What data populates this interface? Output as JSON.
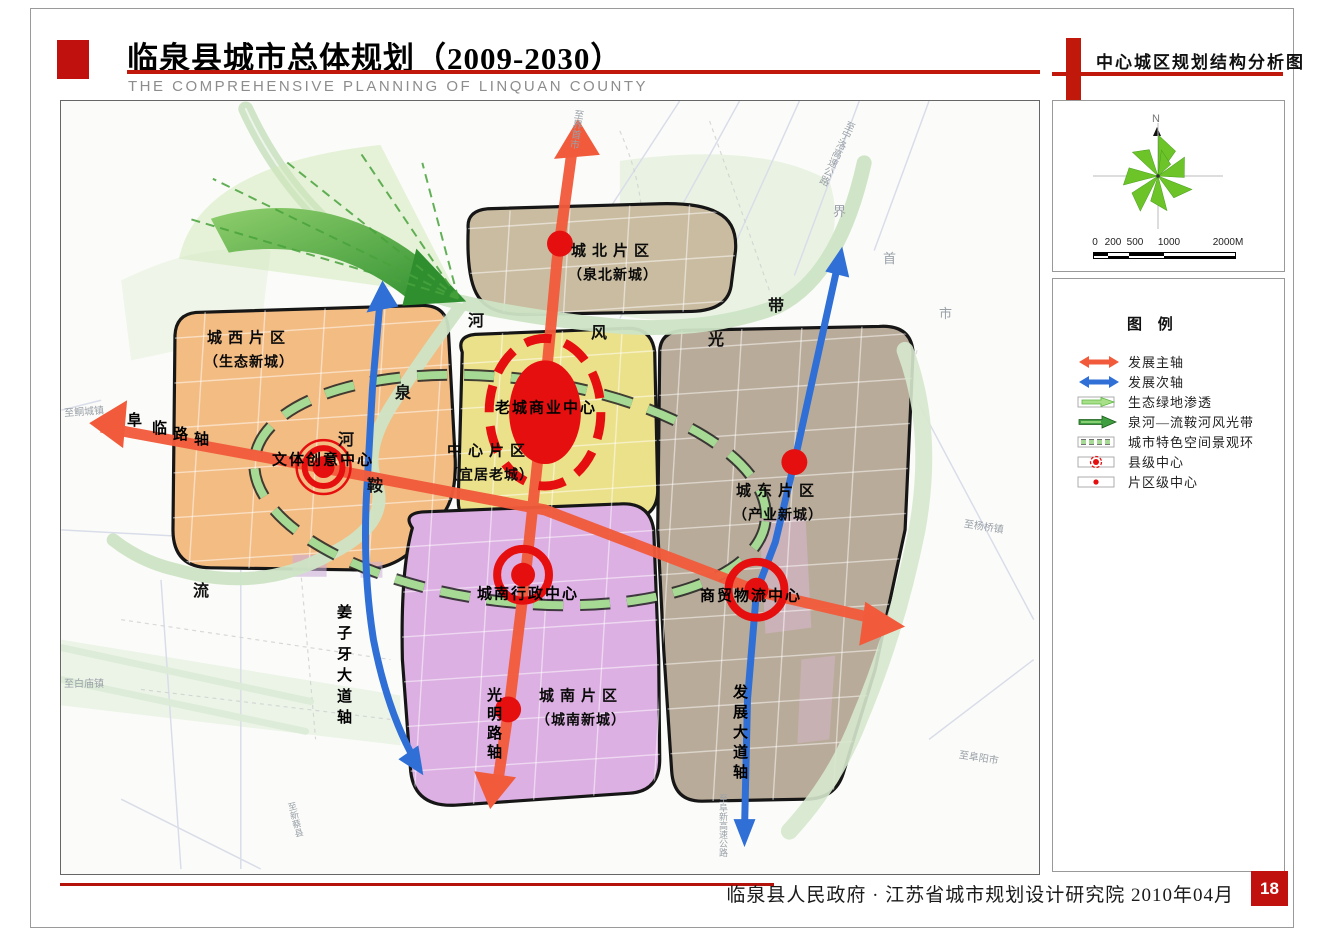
{
  "header": {
    "title": "临泉县城市总体规划（2009-2030）",
    "subtitle": "THE COMPREHENSIVE PLANNING OF LINQUAN COUNTY",
    "map_title": "中心城区规划结构分析图"
  },
  "footer": {
    "credit": "临泉县人民政府 · 江苏省城市规划设计研究院  2010年04月",
    "page": "18"
  },
  "compass": {
    "north": "N"
  },
  "scalebar": {
    "labels": [
      "0",
      "200",
      "500",
      "1000",
      "2000M"
    ]
  },
  "legend": {
    "title": "图 例",
    "items": [
      {
        "id": "main-axis",
        "label": "发展主轴"
      },
      {
        "id": "secondary-axis",
        "label": "发展次轴"
      },
      {
        "id": "eco-green",
        "label": "生态绿地渗透"
      },
      {
        "id": "river-belt",
        "label": "泉河—流鞍河风光带"
      },
      {
        "id": "landscape-ring",
        "label": "城市特色空间景观环"
      },
      {
        "id": "county-center",
        "label": "县级中心"
      },
      {
        "id": "district-center",
        "label": "片区级中心"
      }
    ]
  },
  "districts": {
    "north": {
      "name": "城北片区",
      "alias": "（泉北新城）"
    },
    "west": {
      "name": "城西片区",
      "alias": "（生态新城）"
    },
    "central": {
      "name": "中心片区",
      "alias": "（宜居老城）"
    },
    "east": {
      "name": "城东片区",
      "alias": "（产业新城）"
    },
    "south": {
      "name": "城南片区",
      "alias": "（城南新城）"
    }
  },
  "centers": {
    "commercial": "老城商业中心",
    "culture": "文体创意中心",
    "admin": "城南行政中心",
    "trade": "商贸物流中心"
  },
  "axes": {
    "fulin": [
      "阜",
      "临",
      "路",
      "轴"
    ],
    "jiangziya": "姜子牙大道轴",
    "guangming": "光明路轴",
    "fazhan": "发展大道轴"
  },
  "rivers": {
    "quan": "泉",
    "he1": "河",
    "he2": "河",
    "feng": "风",
    "guang": "光",
    "dai": "带",
    "an": "鞍",
    "liu": "流"
  },
  "roads": {
    "tongcheng": "至鲖城镇",
    "baimiao": "至白庙镇",
    "jieshou": "至界首市",
    "ningluo": "至宁洛高速公路",
    "jie": "界",
    "shou": "首",
    "shi": "市",
    "yangqiao": "至杨桥镇",
    "fuyang": "至阜阳市",
    "xincai": "至新蔡县",
    "fuxin": "至阜新高速公路"
  },
  "colors": {
    "accent_red": "#c1110e",
    "axis_red": "#f15b3b",
    "axis_blue": "#2f6fd6",
    "center_red": "#e60f0f",
    "ring_green": "#a6d994"
  }
}
